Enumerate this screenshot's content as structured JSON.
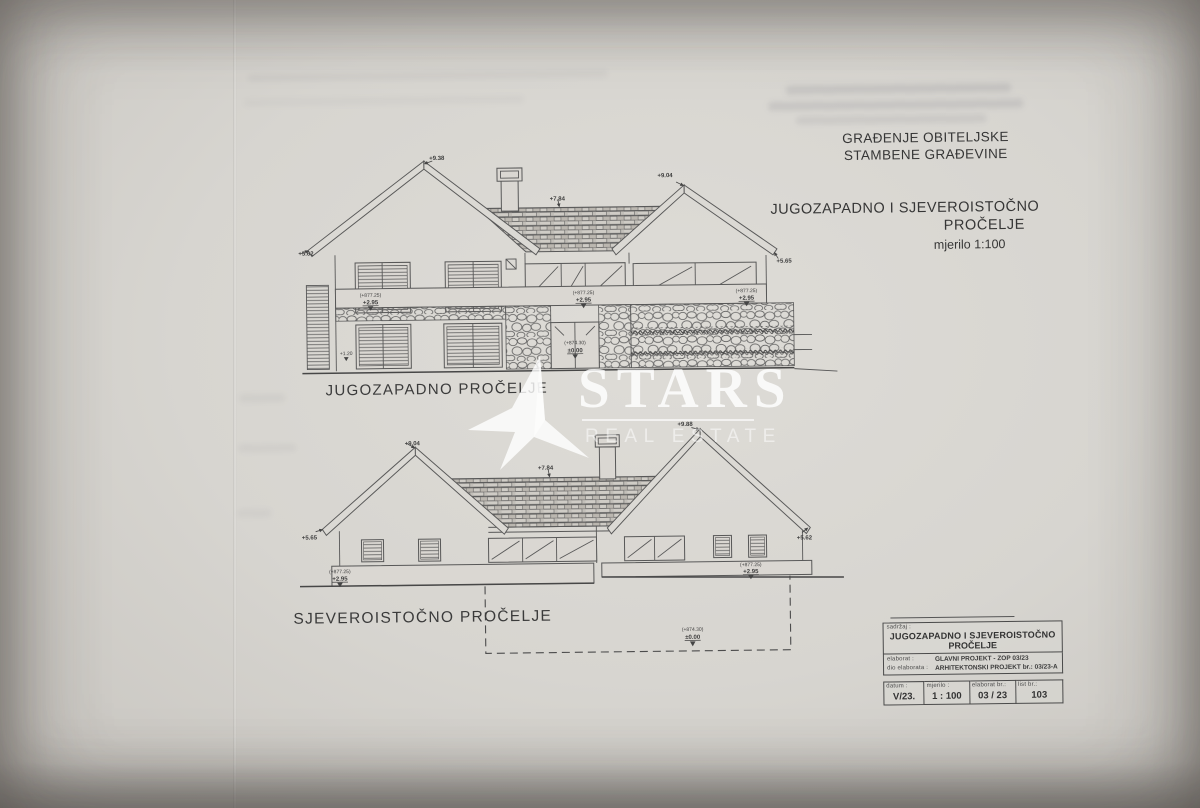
{
  "header": {
    "line1": "GRAĐENJE OBITELJSKE",
    "line2": "STAMBENE GRAĐEVINE"
  },
  "title": {
    "line1": "JUGOZAPADNO I SJEVEROISTOČNO",
    "line2": "PROČELJE",
    "scale": "mjerilo 1:100"
  },
  "levels": {
    "abs_upper": "(+877.25)",
    "upper": "+2.95",
    "abs_ground": "(+874.30)",
    "ground": "±0.00"
  },
  "sw": {
    "caption": "JUGOZAPADNO PROČELJE",
    "labels": {
      "ridge_left": "+9.38",
      "ridge_right": "+9.04",
      "eave_left": "+5.62",
      "eave_right": "+5.65",
      "ridge_mid": "+7.84",
      "plinth": "+1.20"
    }
  },
  "ne": {
    "caption": "SJEVEROISTOČNO PROČELJE",
    "labels": {
      "ridge_left": "+9.04",
      "ridge_right": "+9.88",
      "eave_left": "+5.65",
      "eave_right": "+5.62",
      "ridge_mid": "+7.84"
    }
  },
  "watermark": {
    "brand": "STARS",
    "subtitle": "REAL ESTATE"
  },
  "titleblock": {
    "content_label": "sadržaj :",
    "content_line1": "JUGOZAPADNO I SJEVEROISTOČNO",
    "content_line2": "PROČELJE",
    "rows": [
      {
        "label": "elaborat :",
        "value": "GLAVNI PROJEKT - ZOP 03/23"
      },
      {
        "label": "dio elaborata :",
        "value": "ARHITEKTONSKI PROJEKT br.: 03/23-A"
      }
    ],
    "cols": [
      {
        "label": "datum :",
        "value": "V/23."
      },
      {
        "label": "mjerilo :",
        "value": "1 : 100"
      },
      {
        "label": "elaborat br.:",
        "value": "03 / 23"
      },
      {
        "label": "list br.:",
        "value": "103"
      }
    ]
  }
}
